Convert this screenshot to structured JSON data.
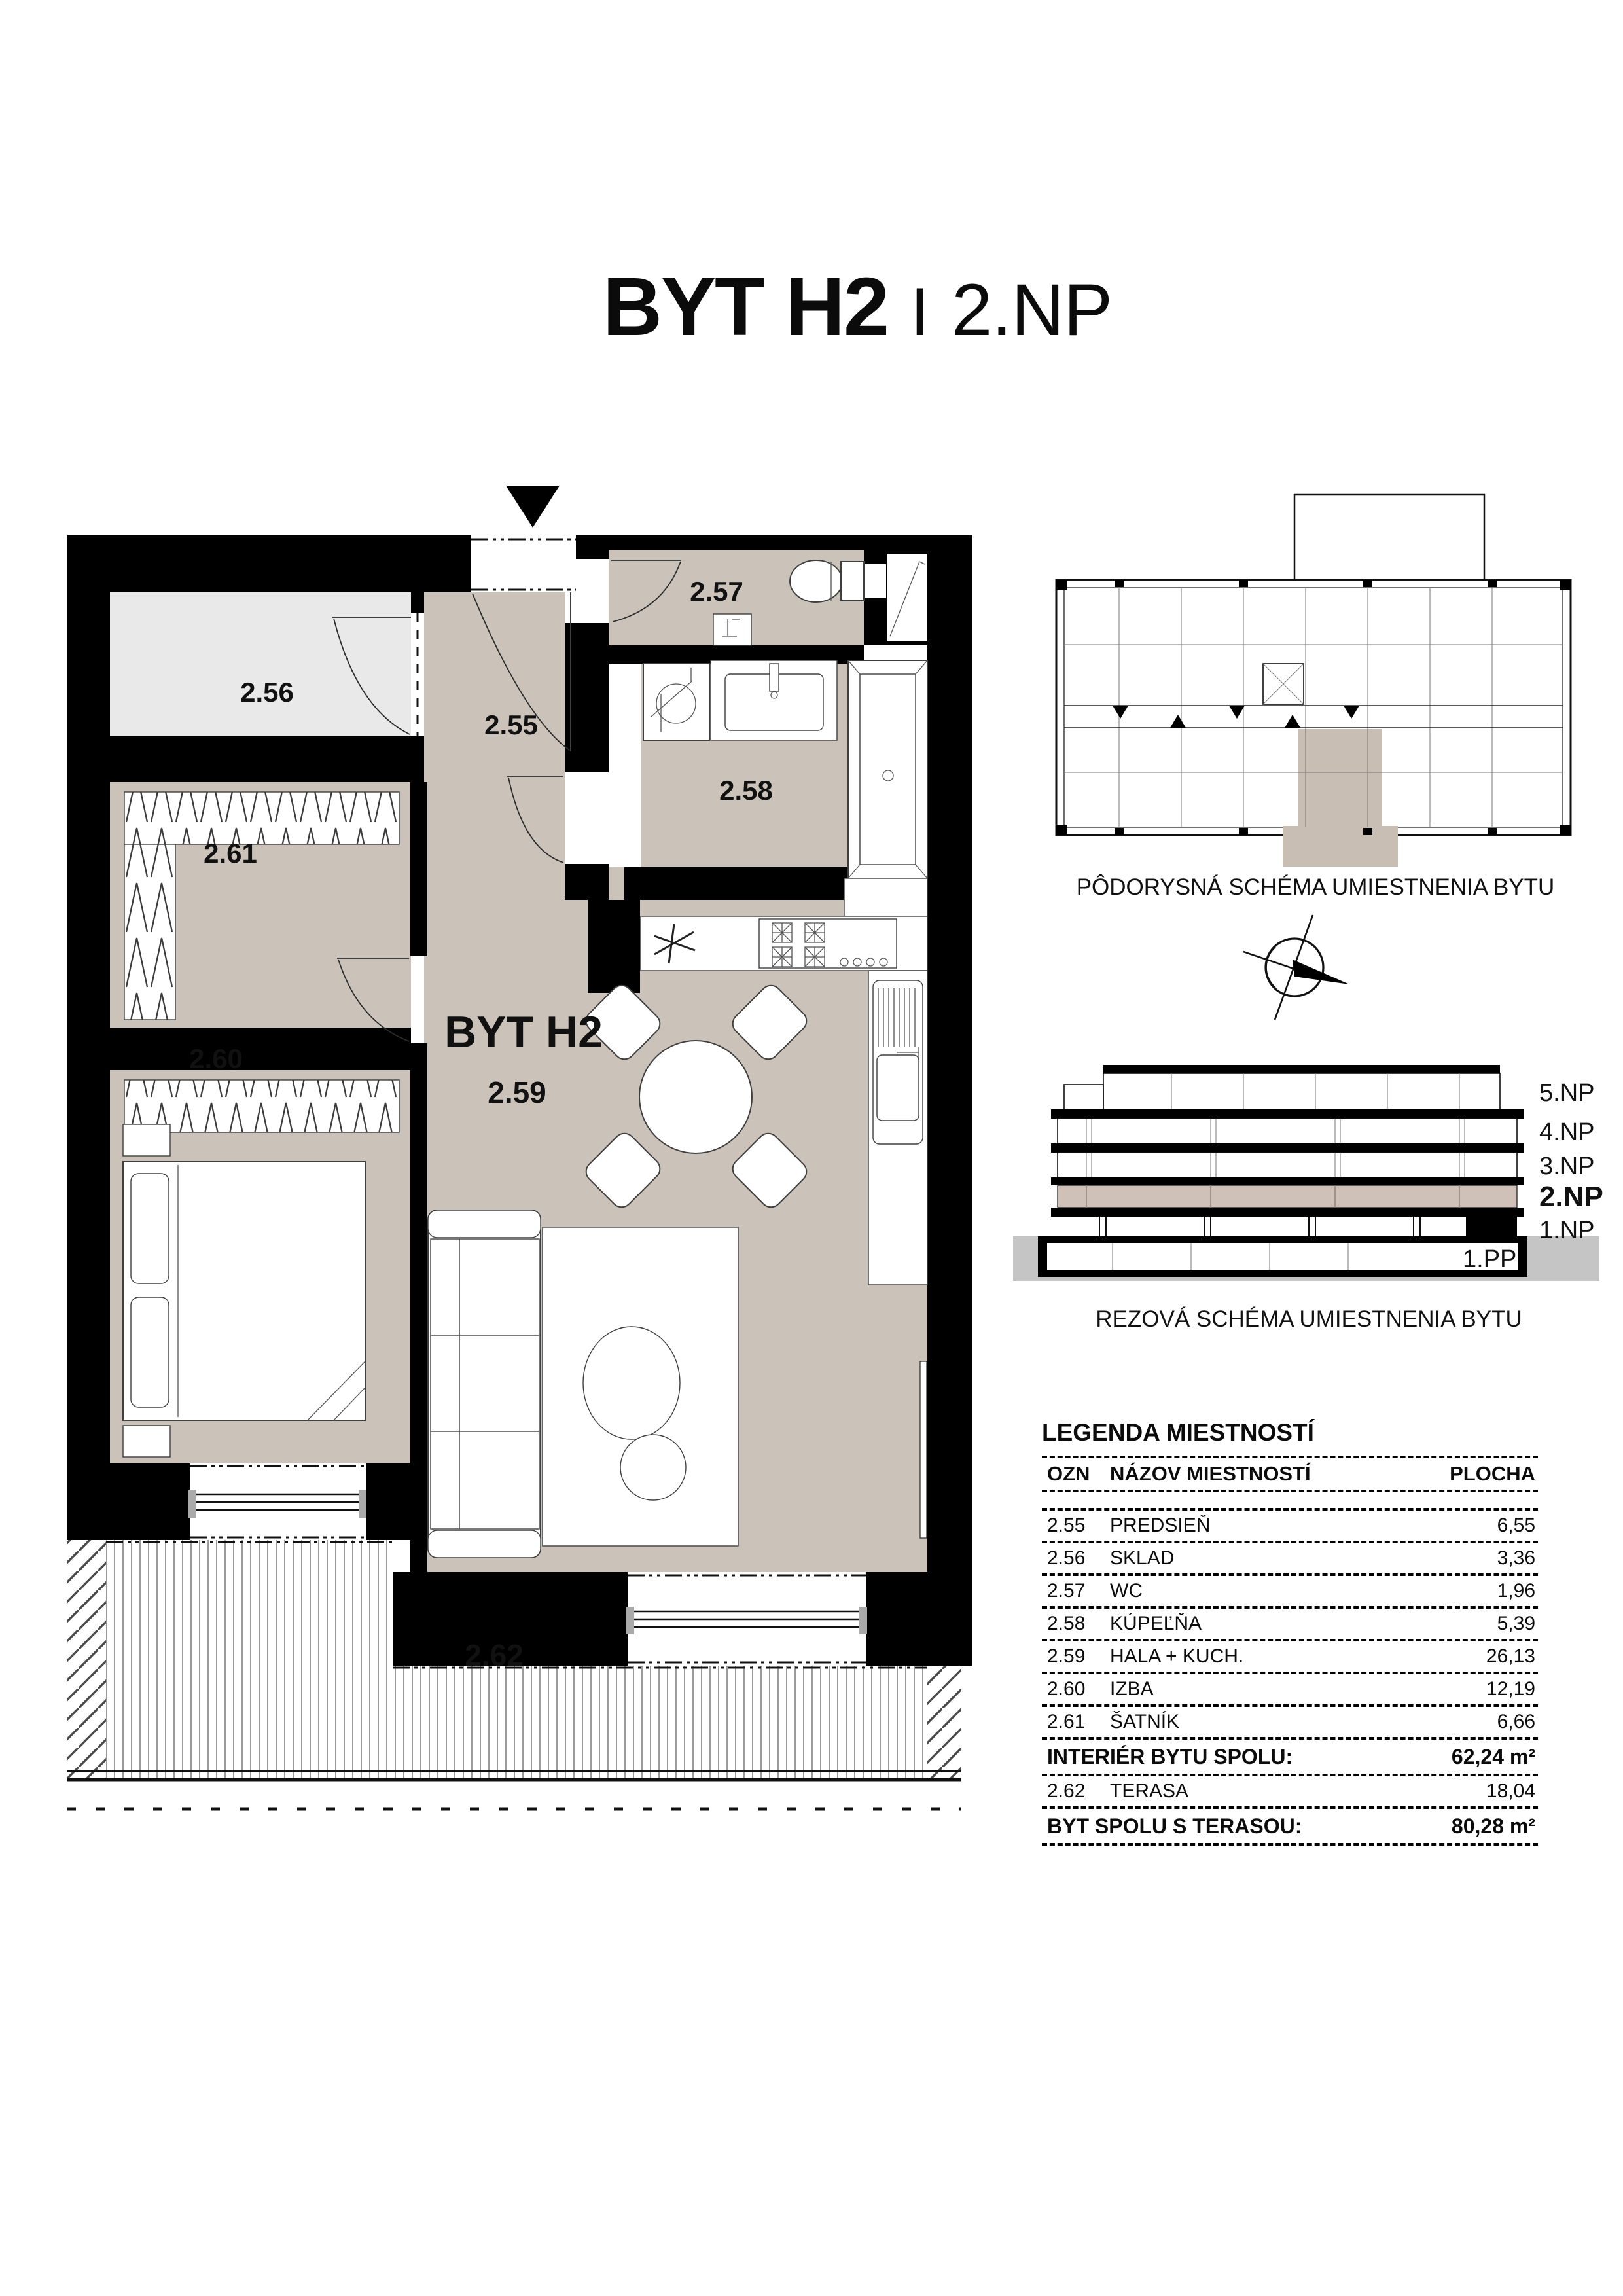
{
  "title": {
    "apartment": "BYT H2",
    "separator": "I",
    "floor": "2.NP"
  },
  "plan": {
    "unit_label": "BYT H2",
    "labels": {
      "hall": "2.55",
      "storage": "2.56",
      "wc": "2.57",
      "bath": "2.58",
      "living": "2.59",
      "bedroom": "2.60",
      "wardrobe": "2.61",
      "terrace": "2.62"
    }
  },
  "location_plan": {
    "caption": "PÔDORYSNÁ SCHÉMA UMIESTNENIA BYTU"
  },
  "section": {
    "caption": "REZOVÁ SCHÉMA UMIESTNENIA BYTU",
    "floors": [
      "5.NP",
      "4.NP",
      "3.NP",
      "2.NP",
      "1.NP",
      "1.PP"
    ],
    "highlighted_floor": "2.NP"
  },
  "legend": {
    "title": "LEGENDA MIESTNOSTÍ",
    "columns": {
      "ozn": "OZN",
      "name": "NÁZOV MIESTNOSTÍ",
      "area": "PLOCHA"
    },
    "rows": [
      {
        "ozn": "2.55",
        "name": "PREDSIEŇ",
        "area": "6,55"
      },
      {
        "ozn": "2.56",
        "name": "SKLAD",
        "area": "3,36"
      },
      {
        "ozn": "2.57",
        "name": "WC",
        "area": "1,96"
      },
      {
        "ozn": "2.58",
        "name": "KÚPEĽŇA",
        "area": "5,39"
      },
      {
        "ozn": "2.59",
        "name": "HALA + KUCH.",
        "area": "26,13"
      },
      {
        "ozn": "2.60",
        "name": "IZBA",
        "area": "12,19"
      },
      {
        "ozn": "2.61",
        "name": "ŠATNÍK",
        "area": "6,66"
      }
    ],
    "interior_total": {
      "label": "INTERIÉR BYTU SPOLU:",
      "value": "62,24 m²"
    },
    "terrace_row": {
      "ozn": "2.62",
      "name": "TERASA",
      "area": "18,04"
    },
    "total": {
      "label": "BYT SPOLU S TERASOU:",
      "value": "80,28 m²"
    }
  },
  "colors": {
    "floor_beige": "#cbc2b9",
    "storage_gray": "#e9e9e9",
    "highlight_beige": "#c9beb3",
    "section_beige": "#cfc1b8",
    "ground_gray": "#c5c5c5",
    "wall_black": "#000000",
    "line_gray": "#9b9b9b"
  }
}
